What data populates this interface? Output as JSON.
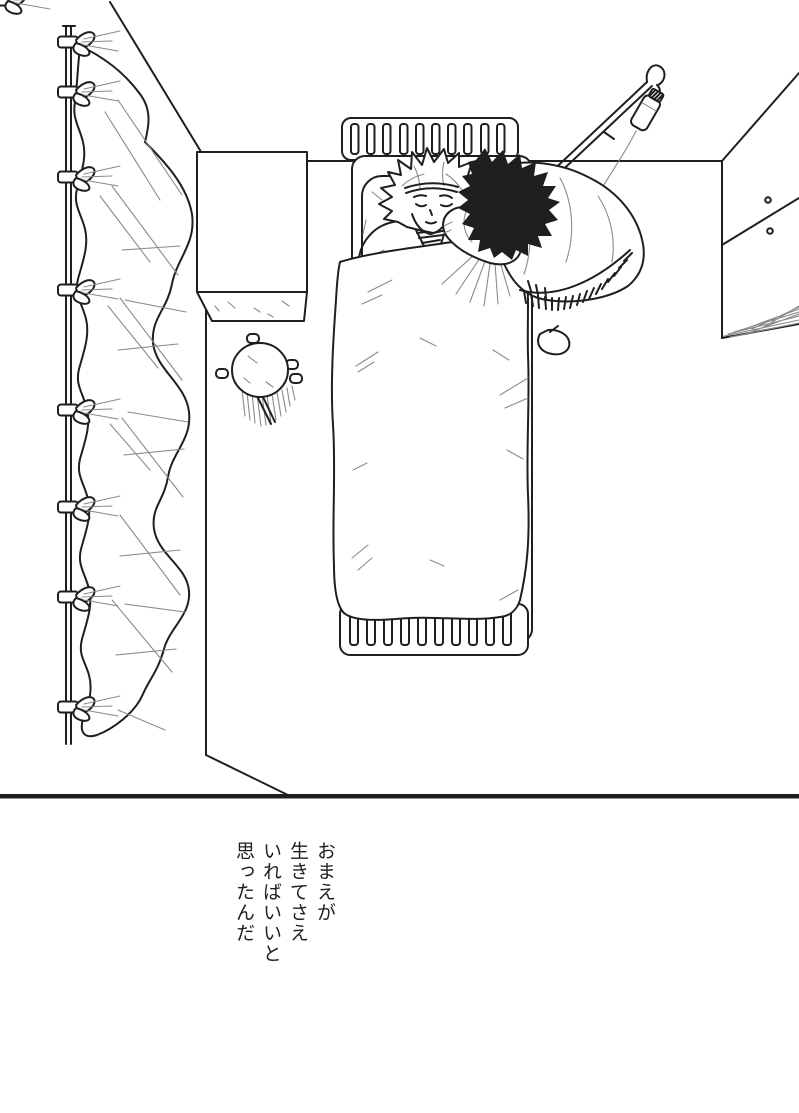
{
  "page": {
    "paper_color": "#ffffff",
    "ink_color": "#1f1f1f",
    "soft_line_color": "#8a8a8a"
  },
  "caption": {
    "text": "おまえが\n生きてさえ\nいればいいと\n思ったんだ",
    "lines": [
      "おまえが",
      "生きてさえ",
      "いればいいと",
      "思ったんだ"
    ]
  }
}
